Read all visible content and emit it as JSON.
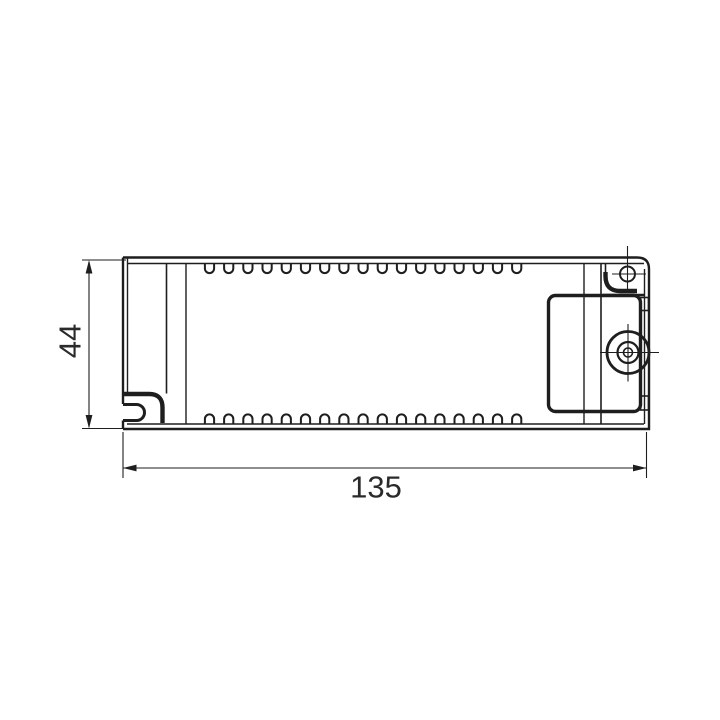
{
  "drawing": {
    "type": "technical-dimension-drawing",
    "view": "enclosure-top-view",
    "background_color": "#ffffff",
    "line_color": "#1e1e1e",
    "dimensions": {
      "width": {
        "value": "135"
      },
      "height": {
        "value": "44"
      }
    },
    "vents": {
      "count": 17,
      "start_x": 209.5,
      "pitch": 19.2,
      "radius": 4.6,
      "depth": 5,
      "top_y": 263.5,
      "bottom_y": 424
    }
  }
}
